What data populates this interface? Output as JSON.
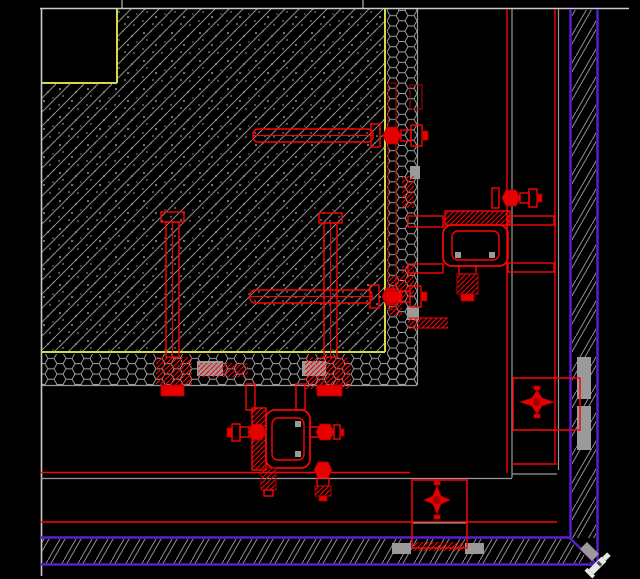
{
  "canvas": {
    "width": 640,
    "height": 579,
    "viewBox": "0 0 640 579",
    "background": "#000000",
    "kind": "cad-curtain-wall-corner-detail-drawing",
    "visible_text": []
  },
  "colors": {
    "background": "#000000",
    "outline_white": "#c9c9c9",
    "hatch_gray": "#8f8f8f",
    "speckle_gray": "#c2c2c2",
    "mesh_gray": "#a6a6a6",
    "plate_gray": "#9a9a9a",
    "yellow": "#d9d943",
    "red": "#fb0505",
    "dark_red": "#a80000",
    "red_fill": "#e60000",
    "purple": "#5a1fd2",
    "cursor_white": "#e8e8e8"
  },
  "components": {
    "structure": [
      "concrete-column-section",
      "insulation-notch",
      "stone-mesh-band-right",
      "stone-mesh-band-bottom",
      "cladding-lines-right",
      "cladding-lines-bottom",
      "finish-band-right",
      "finish-band-bottom",
      "finish-band-corner-miter"
    ],
    "fasteners": [
      "anchor-bolt-top",
      "anchor-bolt-mid",
      "anchor-bolt-left-vertical",
      "anchor-bolt-right-vertical",
      "anchor-channel-right",
      "swivel-connector-right",
      "swivel-connector-bottom",
      "anchor-bolt-bottom-small",
      "embed-plates",
      "weld-marks"
    ],
    "callouts": [
      "detail-box-right",
      "detail-box-bottom"
    ]
  },
  "cursor": {
    "present": true,
    "x": 599,
    "y": 564
  }
}
